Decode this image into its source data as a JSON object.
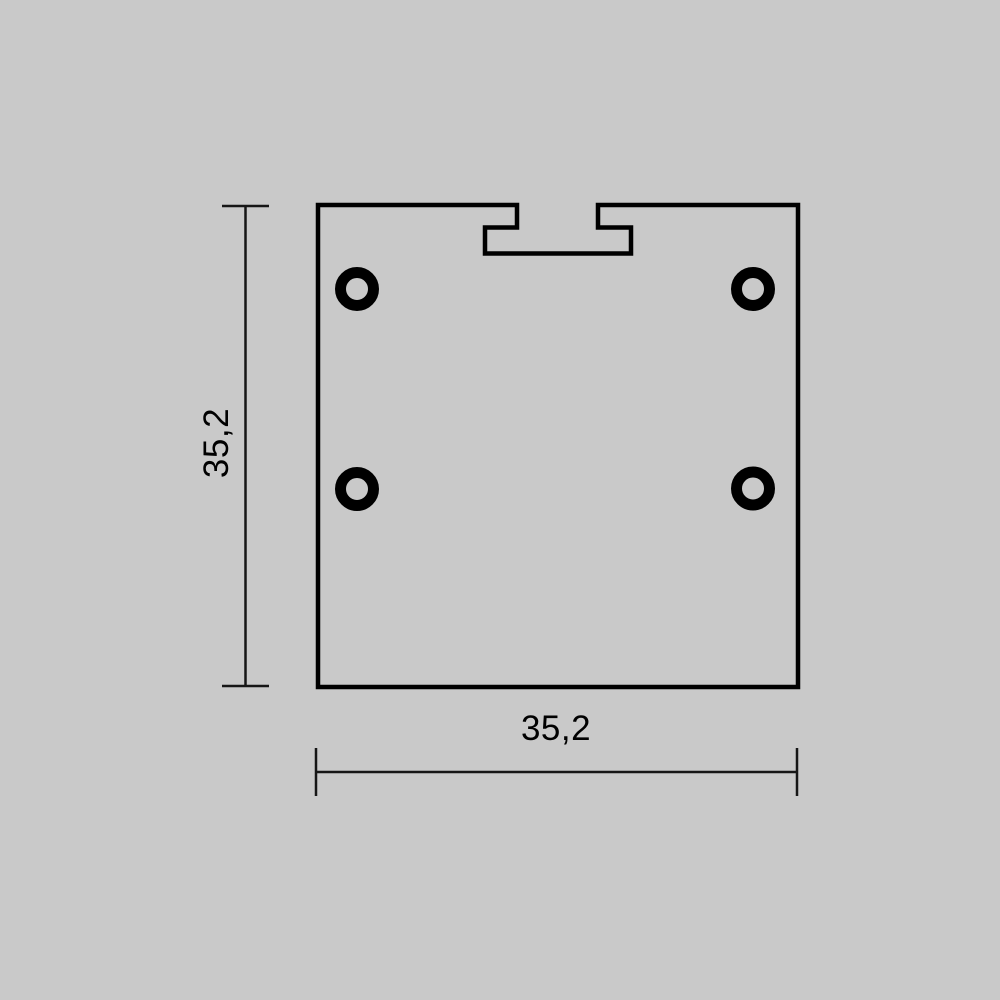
{
  "drawing": {
    "height_dimension": {
      "label": "35,2"
    },
    "width_dimension": {
      "label": "35,2"
    }
  },
  "colors": {
    "canvas-bg": "#c9c9c9",
    "outline": "#000000",
    "dimension-line": "#161616"
  }
}
